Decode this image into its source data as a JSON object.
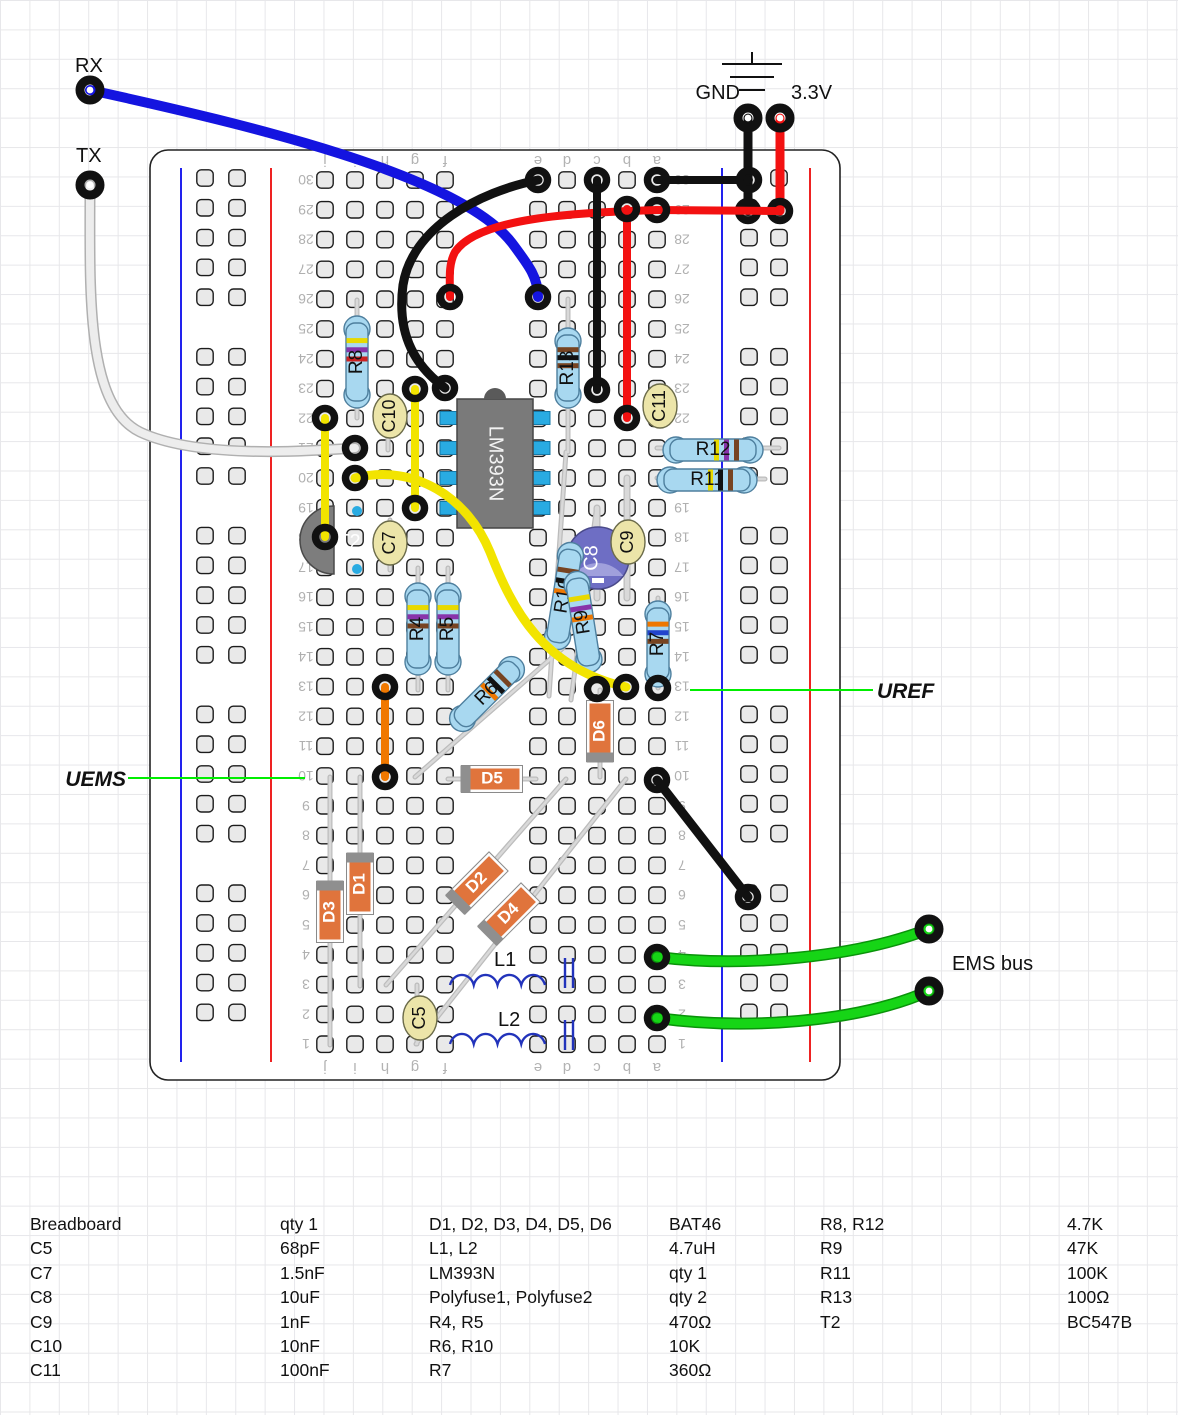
{
  "annotations": {
    "rx": "RX",
    "tx": "TX",
    "gnd": "GND",
    "v33": "3.3V",
    "uems": "UEMS",
    "uref": "UREF",
    "ems_bus": "EMS bus"
  },
  "board": {
    "x": 150,
    "y": 150,
    "w": 690,
    "h": 930,
    "cols": [
      325,
      355,
      385,
      415,
      445,
      538,
      567,
      597,
      627,
      657
    ],
    "letters": [
      "j",
      "i",
      "h",
      "g",
      "f",
      "e",
      "d",
      "c",
      "b",
      "a"
    ],
    "rows": 30,
    "row0_y": 180,
    "pitch": 29.8,
    "num_x_left": 306,
    "num_x_right": 682,
    "letter_y_top": 161,
    "letter_y_bottom": 1068,
    "rail_lines": [
      {
        "x": 181,
        "color": "#2222ee"
      },
      {
        "x": 271,
        "color": "#ee2222"
      },
      {
        "x": 722,
        "color": "#2222ee"
      },
      {
        "x": 810,
        "color": "#ee2222"
      }
    ],
    "rail_cols": [
      205,
      237,
      749,
      779
    ]
  },
  "scene": {
    "leads": [
      [
        357,
        300,
        357,
        418,
        5
      ],
      [
        568,
        299,
        568,
        452,
        5
      ],
      [
        418,
        568,
        418,
        690,
        5
      ],
      [
        448,
        568,
        448,
        690,
        5
      ],
      [
        415,
        777,
        563,
        648,
        5
      ],
      [
        658,
        598,
        658,
        688,
        5
      ],
      [
        566,
        452,
        549,
        696,
        5
      ],
      [
        596,
        512,
        571,
        700,
        5
      ],
      [
        600,
        690,
        600,
        777,
        5
      ],
      [
        448,
        779,
        536,
        779,
        5
      ],
      [
        360,
        777,
        360,
        986,
        5
      ],
      [
        330,
        777,
        330,
        1045,
        5
      ],
      [
        386,
        985,
        566,
        779,
        5
      ],
      [
        416,
        1044,
        626,
        779,
        5
      ],
      [
        627,
        478,
        627,
        598,
        7
      ],
      [
        597,
        508,
        597,
        598,
        7
      ],
      [
        388,
        398,
        388,
        450,
        5
      ],
      [
        390,
        520,
        390,
        570,
        5
      ],
      [
        628,
        518,
        628,
        568,
        5
      ],
      [
        658,
        388,
        658,
        424,
        5
      ],
      [
        417,
        985,
        417,
        1044,
        5
      ],
      [
        657,
        448,
        779,
        448,
        5
      ],
      [
        657,
        478,
        765,
        479,
        5
      ]
    ],
    "resistors": [
      {
        "id": "R8",
        "label": "R8",
        "cx": 357,
        "cy": 362,
        "len": 92,
        "rot": 0,
        "bands": [
          "#e8d900",
          "#8833aa",
          "#cc2222"
        ]
      },
      {
        "id": "R13",
        "label": "R13",
        "cx": 568,
        "cy": 368,
        "len": 80,
        "rot": 0,
        "bands": [
          "#774422",
          "#111111",
          "#774422"
        ]
      },
      {
        "id": "R4",
        "label": "R4",
        "cx": 418,
        "cy": 629,
        "len": 92,
        "rot": 0,
        "bands": [
          "#e8d900",
          "#8833aa",
          "#774422"
        ]
      },
      {
        "id": "R5",
        "label": "R5",
        "cx": 448,
        "cy": 629,
        "len": 92,
        "rot": 0,
        "bands": [
          "#e8d900",
          "#8833aa",
          "#774422"
        ]
      },
      {
        "id": "R6",
        "label": "R6",
        "cx": 487,
        "cy": 694,
        "len": 95,
        "rot": 45,
        "bands": [
          "#774422",
          "#111111",
          "#ee7700"
        ]
      },
      {
        "id": "R7",
        "label": "R7",
        "cx": 658,
        "cy": 644,
        "len": 86,
        "rot": 0,
        "bands": [
          "#ee7700",
          "#2244cc",
          "#774422"
        ]
      },
      {
        "id": "R10",
        "label": "R10",
        "cx": 564,
        "cy": 596,
        "len": 108,
        "rot": 9,
        "bands": [
          "#774422",
          "#111111",
          "#ee7700"
        ]
      },
      {
        "id": "R9",
        "label": "R9",
        "cx": 583,
        "cy": 622,
        "len": 102,
        "rot": -9,
        "bands": [
          "#e8d900",
          "#8833aa",
          "#ee7700"
        ]
      },
      {
        "id": "R12",
        "label": "R12",
        "cx": 713,
        "cy": 450,
        "len": 100,
        "rot": 90,
        "bands": [
          "#774422",
          "#8833aa",
          "#e8d900"
        ]
      },
      {
        "id": "R11",
        "label": "R11",
        "cx": 707,
        "cy": 480,
        "len": 100,
        "rot": 90,
        "bands": [
          "#774422",
          "#111111",
          "#e8d900"
        ]
      }
    ],
    "diodes": [
      {
        "id": "D6",
        "label": "D6",
        "cx": 600,
        "cy": 731,
        "rot": 0,
        "stripe": "bottom"
      },
      {
        "id": "D5",
        "label": "D5",
        "cx": 492,
        "cy": 779,
        "rot": 90,
        "stripe": "bottom"
      },
      {
        "id": "D1",
        "label": "D1",
        "cx": 360,
        "cy": 884,
        "rot": 0,
        "stripe": "top"
      },
      {
        "id": "D3",
        "label": "D3",
        "cx": 330,
        "cy": 912,
        "rot": 0,
        "stripe": "top"
      },
      {
        "id": "D2",
        "label": "D2",
        "cx": 477,
        "cy": 883,
        "rot": 45,
        "stripe": "bottom"
      },
      {
        "id": "D4",
        "label": "D4",
        "cx": 509,
        "cy": 914,
        "rot": 45,
        "stripe": "bottom"
      }
    ],
    "caps": [
      {
        "id": "C10",
        "label": "C10",
        "cx": 390,
        "cy": 416
      },
      {
        "id": "C7",
        "label": "C7",
        "cx": 390,
        "cy": 543
      },
      {
        "id": "C9",
        "label": "C9",
        "cx": 628,
        "cy": 542
      },
      {
        "id": "C11",
        "label": "C11",
        "cx": 660,
        "cy": 406
      },
      {
        "id": "C5",
        "label": "C5",
        "cx": 420,
        "cy": 1018
      }
    ],
    "ecap": {
      "id": "C8",
      "label": "C8",
      "cx": 598,
      "cy": 558,
      "r": 31
    },
    "ic": {
      "id": "LM393N",
      "label": "LM393N",
      "x": 457,
      "y": 399,
      "w": 76,
      "h": 129,
      "pin_ys": [
        418,
        448,
        478,
        508
      ]
    },
    "transistor": {
      "id": "T2",
      "label": "T2",
      "cx": 334,
      "cy": 540,
      "r": 34,
      "dots": [
        [
          357,
          511
        ],
        [
          357,
          569
        ]
      ]
    },
    "inductors": [
      {
        "id": "L1",
        "label": "L1",
        "x1": 450,
        "x2": 545,
        "y": 985,
        "bars_x": [
          565,
          573
        ],
        "bar_y1": 958,
        "bar_y2": 988,
        "lx": 494,
        "ly": 966
      },
      {
        "id": "L2",
        "label": "L2",
        "x1": 450,
        "x2": 545,
        "y": 1044,
        "bars_x": [
          565,
          573
        ],
        "bar_y1": 1020,
        "bar_y2": 1050,
        "lx": 498,
        "ly": 1026
      }
    ],
    "wires": [
      {
        "id": "tx-white",
        "color": "#ededed",
        "outline": "#b0b0b0",
        "w": 8,
        "path": "M90,185 C90,290 85,405 140,432 C195,458 300,452 355,448",
        "rings": [
          [
            355,
            448
          ]
        ]
      },
      {
        "id": "rx-blue",
        "color": "#1414e0",
        "w": 10,
        "path": "M90,90 C250,125 460,175 512,243 C530,267 538,278 538,297",
        "rings": [
          [
            538,
            297
          ]
        ]
      },
      {
        "id": "gnd-black",
        "color": "#111111",
        "w": 9,
        "path": "M748,118 L748,211",
        "rings": [
          [
            748,
            211
          ]
        ]
      },
      {
        "id": "v33-red",
        "color": "#f31111",
        "w": 9,
        "path": "M780,118 L780,211",
        "rings": [
          [
            780,
            211
          ]
        ]
      },
      {
        "id": "a30-rail-black",
        "color": "#111111",
        "w": 8,
        "path": "M657,180 L749,180",
        "rings": [
          [
            657,
            180
          ],
          [
            749,
            180
          ]
        ]
      },
      {
        "id": "a29-rail-red",
        "color": "#f31111",
        "w": 8,
        "path": "M657,210 L780,211",
        "rings": [
          [
            657,
            210
          ]
        ]
      },
      {
        "id": "red-f26",
        "color": "#f31111",
        "w": 8,
        "path": "M657,210 C570,213 478,218 455,252 C448,265 450,280 450,297",
        "rings": [
          [
            450,
            297
          ]
        ]
      },
      {
        "id": "black-e30-f23",
        "color": "#111111",
        "w": 9,
        "path": "M538,180 C478,192 412,228 403,285 C396,338 418,368 445,388",
        "rings": [
          [
            538,
            180
          ],
          [
            445,
            388
          ]
        ]
      },
      {
        "id": "c30-c23-black",
        "color": "#111111",
        "w": 8,
        "path": "M597,180 L597,390",
        "rings": [
          [
            597,
            180
          ],
          [
            597,
            390
          ]
        ]
      },
      {
        "id": "b29-b22-red",
        "color": "#f31111",
        "w": 8,
        "path": "M627,209 L627,418",
        "rings": [
          [
            627,
            209
          ],
          [
            627,
            418
          ]
        ]
      },
      {
        "id": "j22-j18-yellow",
        "color": "#f2e400",
        "w": 8,
        "path": "M325,418 L325,537",
        "rings": [
          [
            325,
            418
          ],
          [
            325,
            537
          ]
        ]
      },
      {
        "id": "g23-g19-yellow",
        "color": "#f2e400",
        "w": 8,
        "path": "M415,389 L415,508",
        "rings": [
          [
            415,
            389
          ],
          [
            415,
            508
          ]
        ]
      },
      {
        "id": "i20-b13-yellow",
        "color": "#f2e400",
        "w": 9,
        "path": "M355,478 C415,463 468,498 490,552 C512,608 542,668 626,687",
        "rings": [
          [
            355,
            478
          ],
          [
            626,
            687
          ]
        ]
      },
      {
        "id": "h13-h10-orange",
        "color": "#f07800",
        "w": 8,
        "path": "M385,687 L385,777",
        "rings": [
          [
            385,
            687
          ],
          [
            385,
            777
          ]
        ]
      },
      {
        "id": "a10-rail-black",
        "color": "#111111",
        "w": 9,
        "path": "M657,780 L748,897",
        "rings": [
          [
            657,
            780
          ],
          [
            748,
            897
          ]
        ]
      },
      {
        "id": "ems1-green",
        "color": "#16d516",
        "outline": "#0a930a",
        "w": 9,
        "path": "M657,957 C745,968 856,957 929,929",
        "rings": [
          [
            657,
            957
          ]
        ]
      },
      {
        "id": "ems2-green",
        "color": "#16d516",
        "outline": "#0a930a",
        "w": 9,
        "path": "M657,1018 C745,1030 856,1023 929,991",
        "rings": [
          [
            657,
            1018
          ]
        ]
      }
    ],
    "extra_rings": [
      [
        597,
        689
      ],
      [
        658,
        688
      ]
    ],
    "pins": [
      {
        "id": "rx",
        "x": 90,
        "y": 90
      },
      {
        "id": "tx",
        "x": 90,
        "y": 185
      },
      {
        "id": "gnd",
        "x": 748,
        "y": 118
      },
      {
        "id": "v33",
        "x": 780,
        "y": 118
      },
      {
        "id": "ems1",
        "x": 929,
        "y": 929
      },
      {
        "id": "ems2",
        "x": 929,
        "y": 991
      }
    ],
    "green_lines": [
      [
        128,
        778,
        305,
        778
      ],
      [
        690,
        690,
        873,
        690
      ]
    ],
    "gnd_symbol": [
      [
        752,
        52,
        752,
        64
      ],
      [
        722,
        64,
        782,
        64
      ],
      [
        730,
        77,
        774,
        77
      ],
      [
        739,
        90,
        765,
        90
      ]
    ]
  },
  "parts_list": {
    "columns": [
      {
        "name_x": 30,
        "value_x": 280,
        "entries": [
          [
            "Breadboard",
            "qty 1"
          ],
          [
            "C5",
            "68pF"
          ],
          [
            "C7",
            "1.5nF"
          ],
          [
            "C8",
            "10uF"
          ],
          [
            "C9",
            "1nF"
          ],
          [
            "C10",
            "10nF"
          ],
          [
            "C11",
            "100nF"
          ]
        ]
      },
      {
        "name_x": 429,
        "value_x": 669,
        "entries": [
          [
            "D1, D2, D3, D4, D5, D6",
            "BAT46"
          ],
          [
            "L1, L2",
            "4.7uH"
          ],
          [
            "LM393N",
            "qty 1"
          ],
          [
            "Polyfuse1, Polyfuse2",
            "qty 2"
          ],
          [
            "R4, R5",
            "470Ω"
          ],
          [
            "R6, R10",
            "10K"
          ],
          [
            "R7",
            "360Ω"
          ]
        ]
      },
      {
        "name_x": 820,
        "value_x": 1067,
        "entries": [
          [
            "R8, R12",
            "4.7K"
          ],
          [
            "R9",
            "47K"
          ],
          [
            "R11",
            "100K"
          ],
          [
            "R13",
            "100Ω"
          ],
          [
            "T2",
            "BC547B"
          ]
        ]
      }
    ],
    "top_y": 1212,
    "line_h": 24.4
  }
}
